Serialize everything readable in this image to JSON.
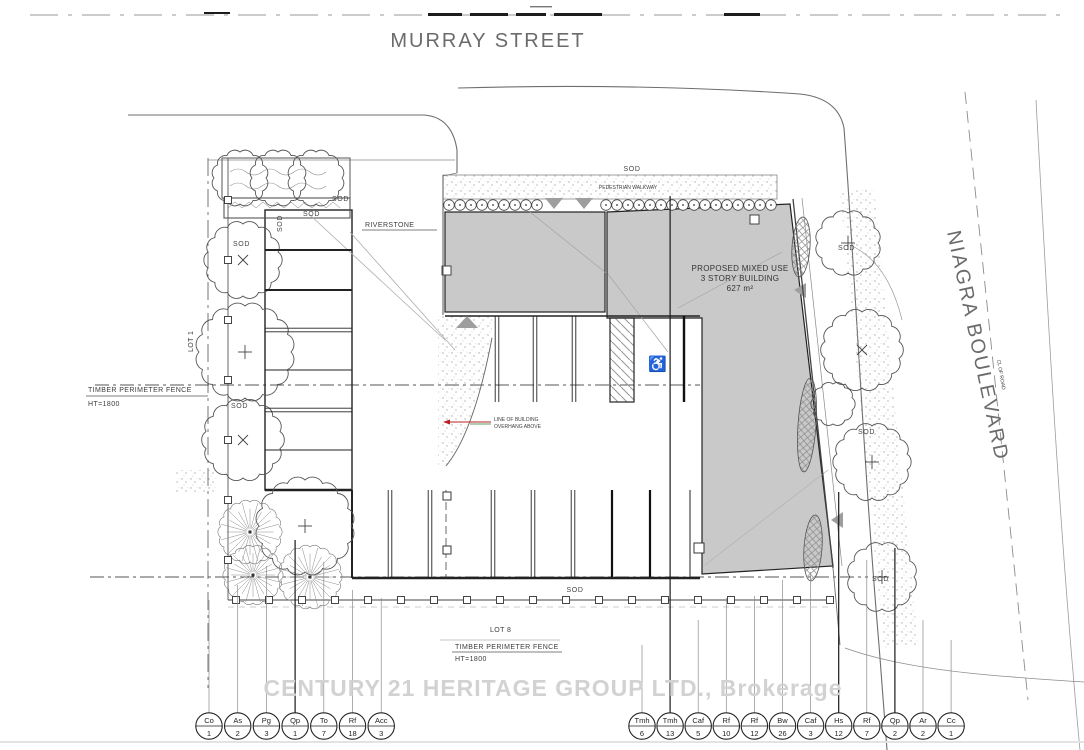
{
  "title": {
    "street_top": "MURRAY STREET",
    "street_right": "NIAGRA BOULEVARD",
    "cl_of_road": "CL OF ROAD"
  },
  "building": {
    "line1": "PROPOSED MIXED USE",
    "line2": "3 STORY BUILDING",
    "line3": "627 m²"
  },
  "labels": {
    "sod": "SOD",
    "riverstone": "RIVERSTONE",
    "pedestrian_walkway": "PEDESTRIAN WALKWAY",
    "lot1": "LOT 1",
    "lot8": "LOT 8",
    "fence_line1": "TIMBER PERIMETER FENCE",
    "fence_line2": "HT=1800",
    "overhang_line1": "LINE OF BUILDING",
    "overhang_line2": "OVERHANG ABOVE"
  },
  "watermark": "CENTURY 21 HERITAGE GROUP LTD., Brokerage",
  "icons": {
    "wheelchair": "♿"
  },
  "colors": {
    "building_fill": "#c9c9c9",
    "line": "#3a3a3a",
    "accent_red": "#bb2222",
    "street_text": "#6b6b6b",
    "watermark": "#d2d2d2",
    "triangle": "#9e9e9e"
  },
  "plant_schedule": {
    "left": [
      {
        "code": "Co",
        "count": "1"
      },
      {
        "code": "As",
        "count": "2"
      },
      {
        "code": "Pg",
        "count": "3"
      },
      {
        "code": "Qp",
        "count": "1"
      },
      {
        "code": "To",
        "count": "7"
      },
      {
        "code": "Rf",
        "count": "18"
      },
      {
        "code": "Acc",
        "count": "3"
      }
    ],
    "right": [
      {
        "code": "Tmh",
        "count": "6"
      },
      {
        "code": "Tmh",
        "count": "13"
      },
      {
        "code": "Caf",
        "count": "5"
      },
      {
        "code": "Rf",
        "count": "10"
      },
      {
        "code": "Rf",
        "count": "12"
      },
      {
        "code": "Bw",
        "count": "26"
      },
      {
        "code": "Caf",
        "count": "3"
      },
      {
        "code": "Hs",
        "count": "12"
      },
      {
        "code": "Rf",
        "count": "7"
      },
      {
        "code": "Qp",
        "count": "2"
      },
      {
        "code": "Ar",
        "count": "2"
      },
      {
        "code": "Cc",
        "count": "1"
      }
    ]
  }
}
